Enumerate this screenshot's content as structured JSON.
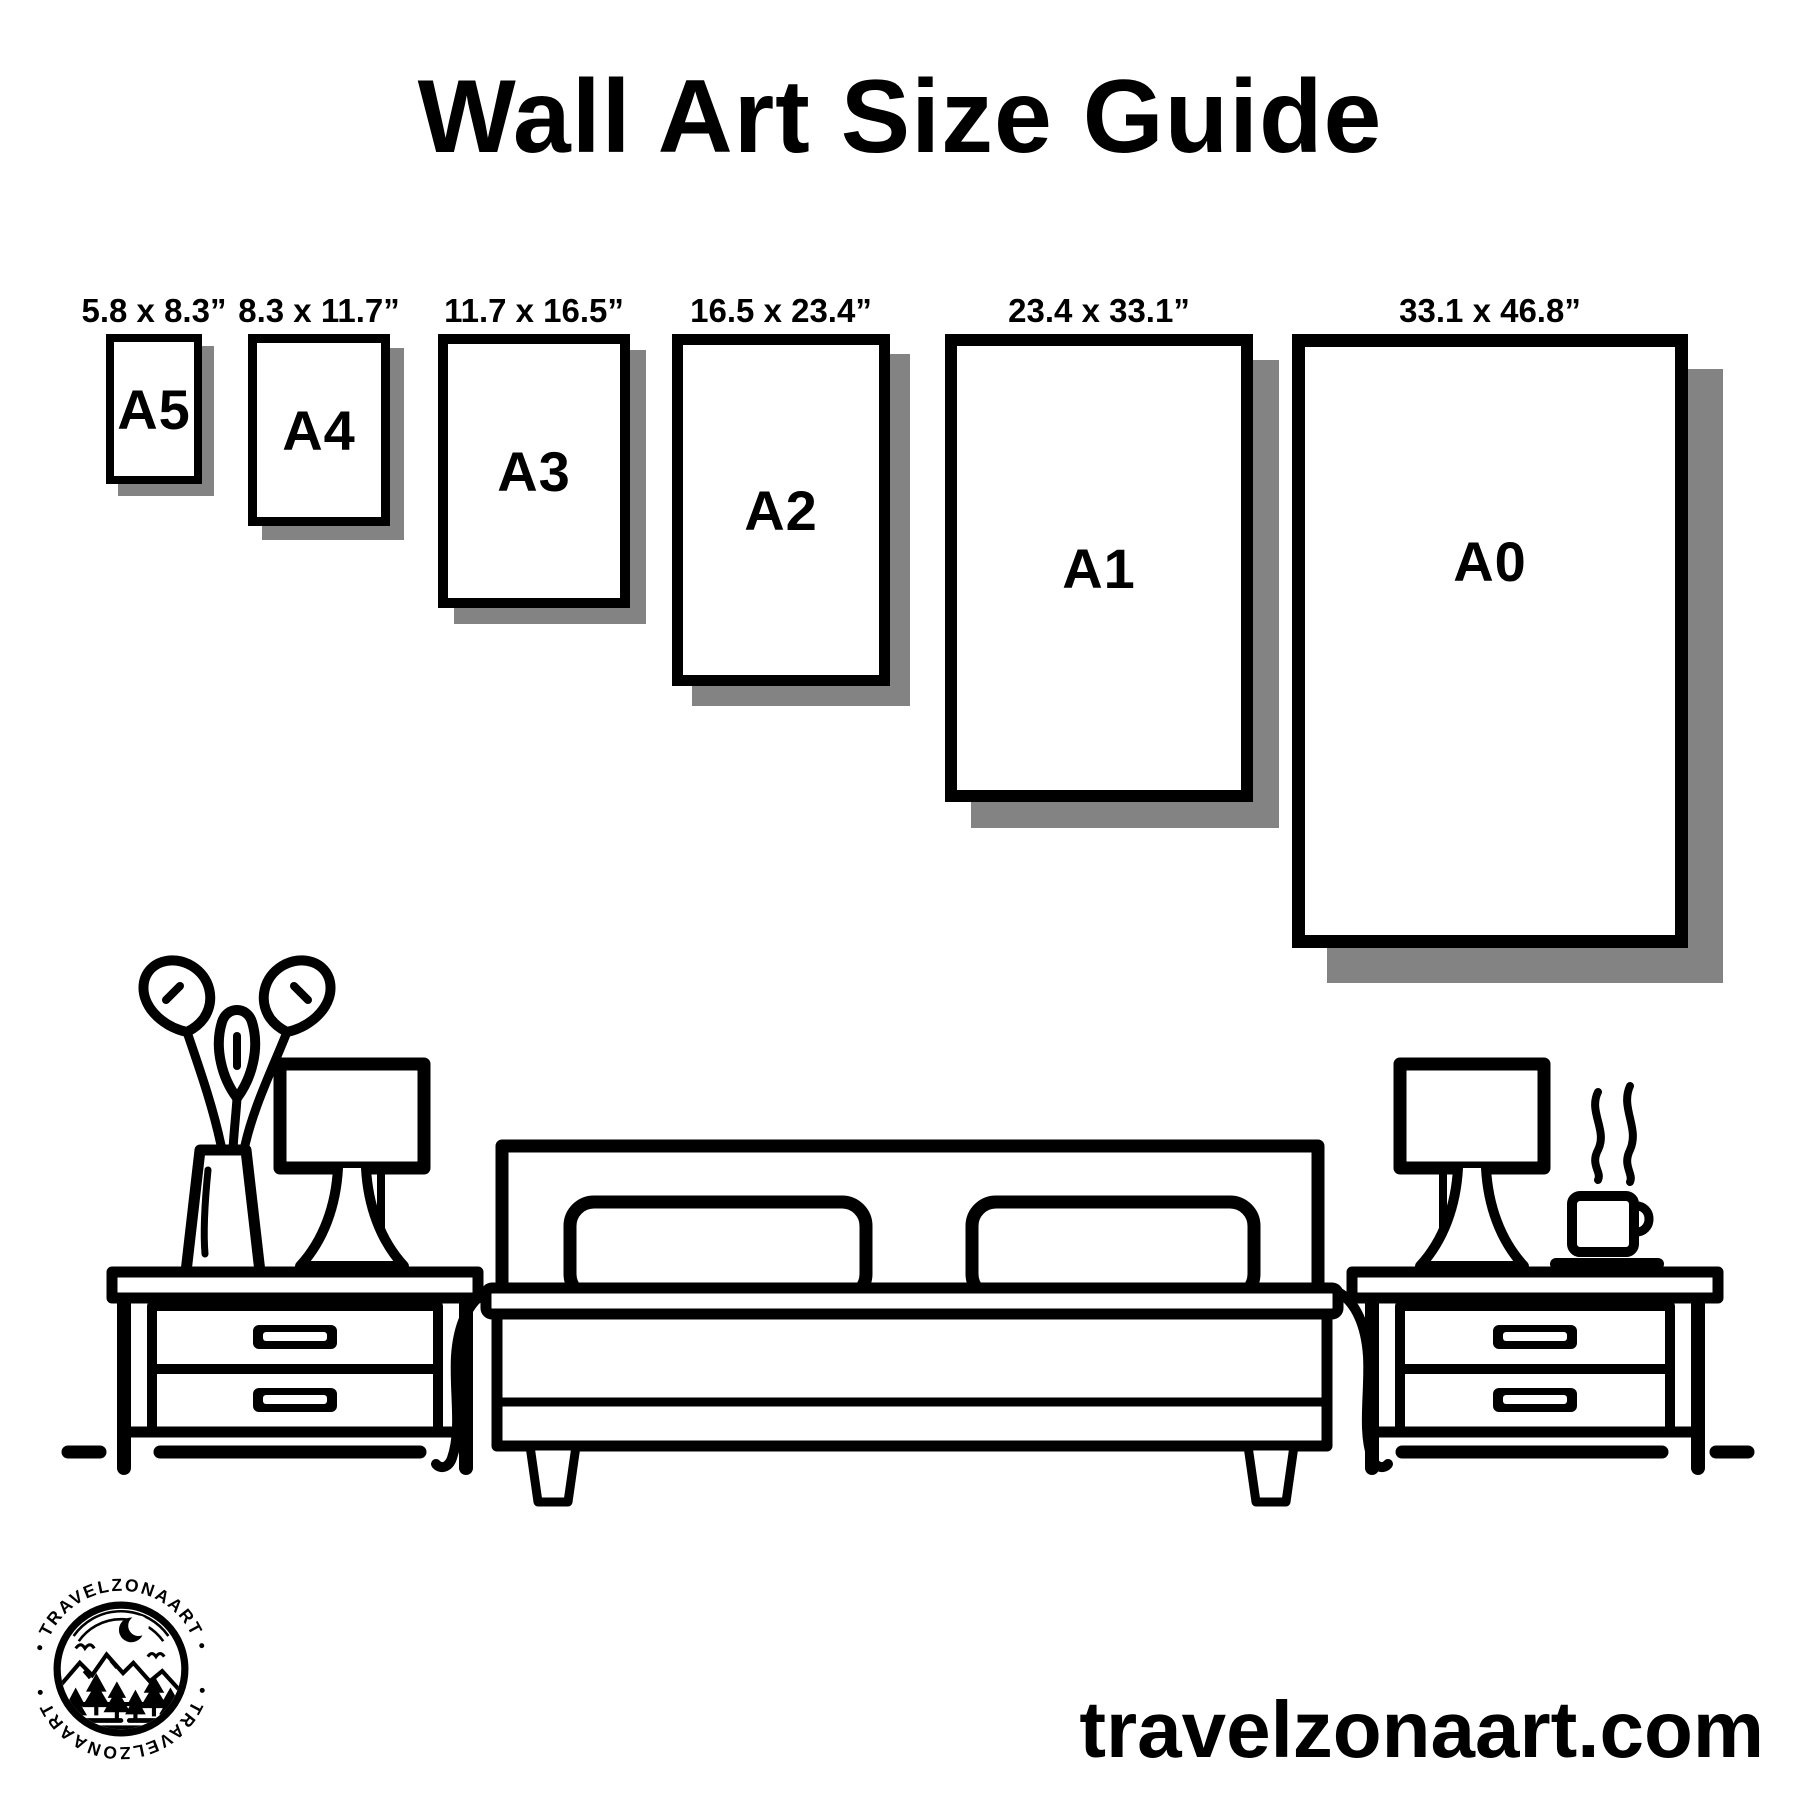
{
  "palette": {
    "ink": "#000000",
    "paper": "#ffffff",
    "shadow": "#838383"
  },
  "title": "Wall Art Size Guide",
  "size_guide": {
    "frames": [
      {
        "name": "A5",
        "dimensions_label": "5.8 x 8.3”"
      },
      {
        "name": "A4",
        "dimensions_label": "8.3 x 11.7”"
      },
      {
        "name": "A3",
        "dimensions_label": "11.7 x 16.5”"
      },
      {
        "name": "A2",
        "dimensions_label": "16.5 x 23.4”"
      },
      {
        "name": "A1",
        "dimensions_label": "23.4 x 33.1”"
      },
      {
        "name": "A0",
        "dimensions_label": "33.1 x 46.8”"
      }
    ]
  },
  "logo": {
    "arc_text_top": "• TRAVELZONAART •",
    "arc_text_bottom": "• TRAVELZONAART •"
  },
  "footer": {
    "website": "travelzonaart.com"
  }
}
